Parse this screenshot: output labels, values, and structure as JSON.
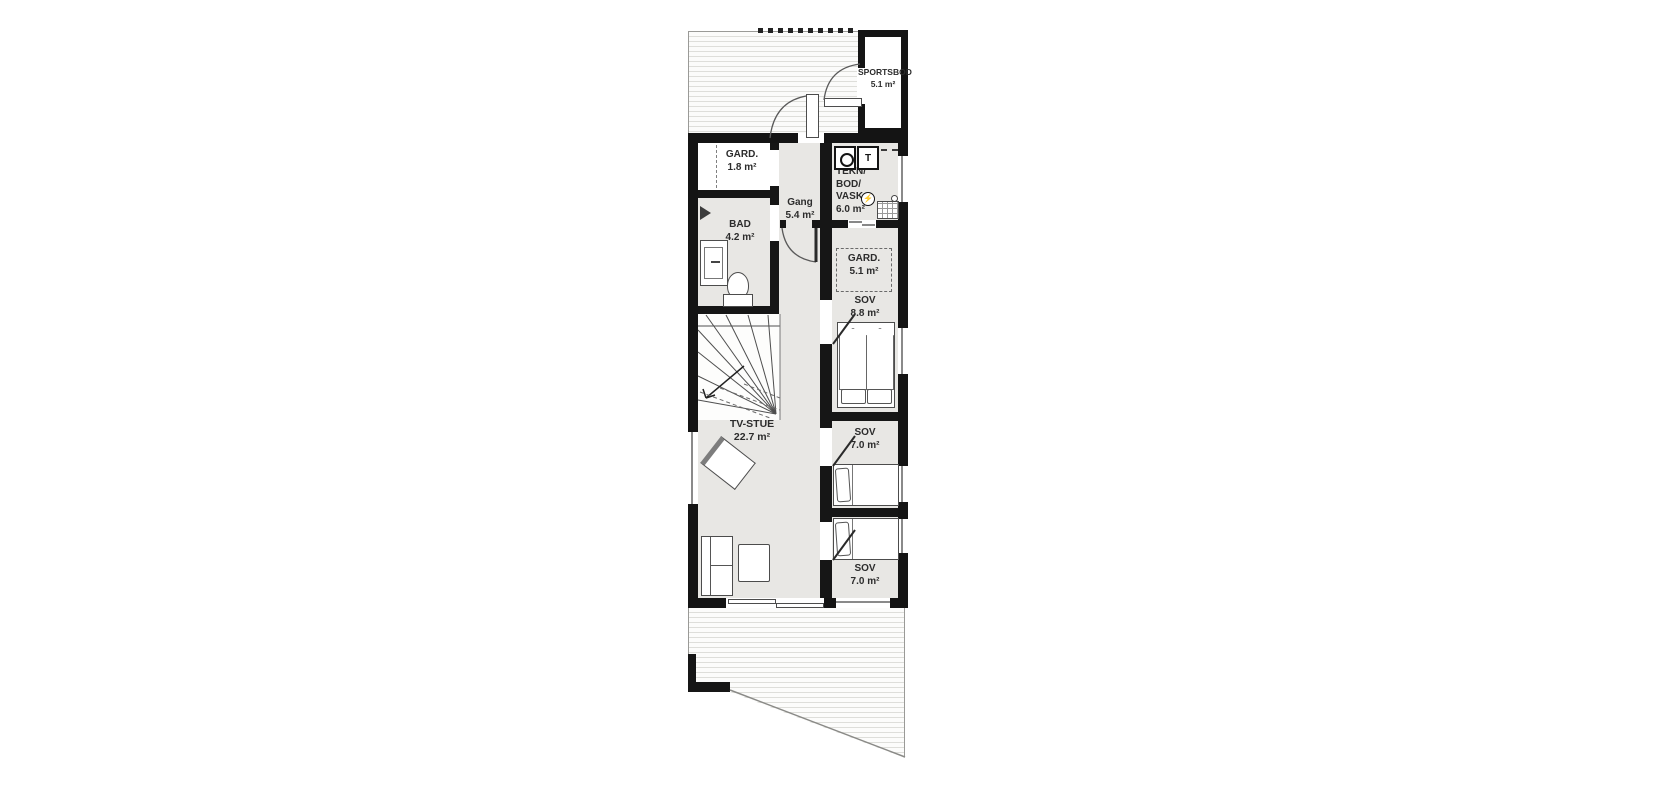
{
  "plan": {
    "title": "floor-plan",
    "rooms": {
      "sportsbod": {
        "name": "SPORTSBOD",
        "area": "5.1 m²"
      },
      "gard_entry": {
        "name": "GARD.",
        "area": "1.8 m²"
      },
      "bad": {
        "name": "BAD",
        "area": "4.2 m²"
      },
      "gang": {
        "name": "Gang",
        "area": "5.4 m²"
      },
      "tekn": {
        "line1": "TEKN/",
        "line2": "BOD/",
        "line3": "VASK",
        "area": "6.0 m²"
      },
      "gard_sov": {
        "name": "GARD.",
        "area": "5.1 m²"
      },
      "sov_main": {
        "name": "SOV",
        "area": "8.8 m²"
      },
      "tv_stue": {
        "name": "TV-STUE",
        "area": "22.7 m²"
      },
      "sov_upper": {
        "name": "SOV",
        "area": "7.0 m²"
      },
      "sov_lower": {
        "name": "SOV",
        "area": "7.0 m²"
      }
    },
    "symbols": {
      "dryer_label": "T",
      "electrical": "⚡"
    },
    "colors": {
      "wall": "#161616",
      "room_gray": "#e8e7e4",
      "deck_line": "#dededa"
    }
  }
}
